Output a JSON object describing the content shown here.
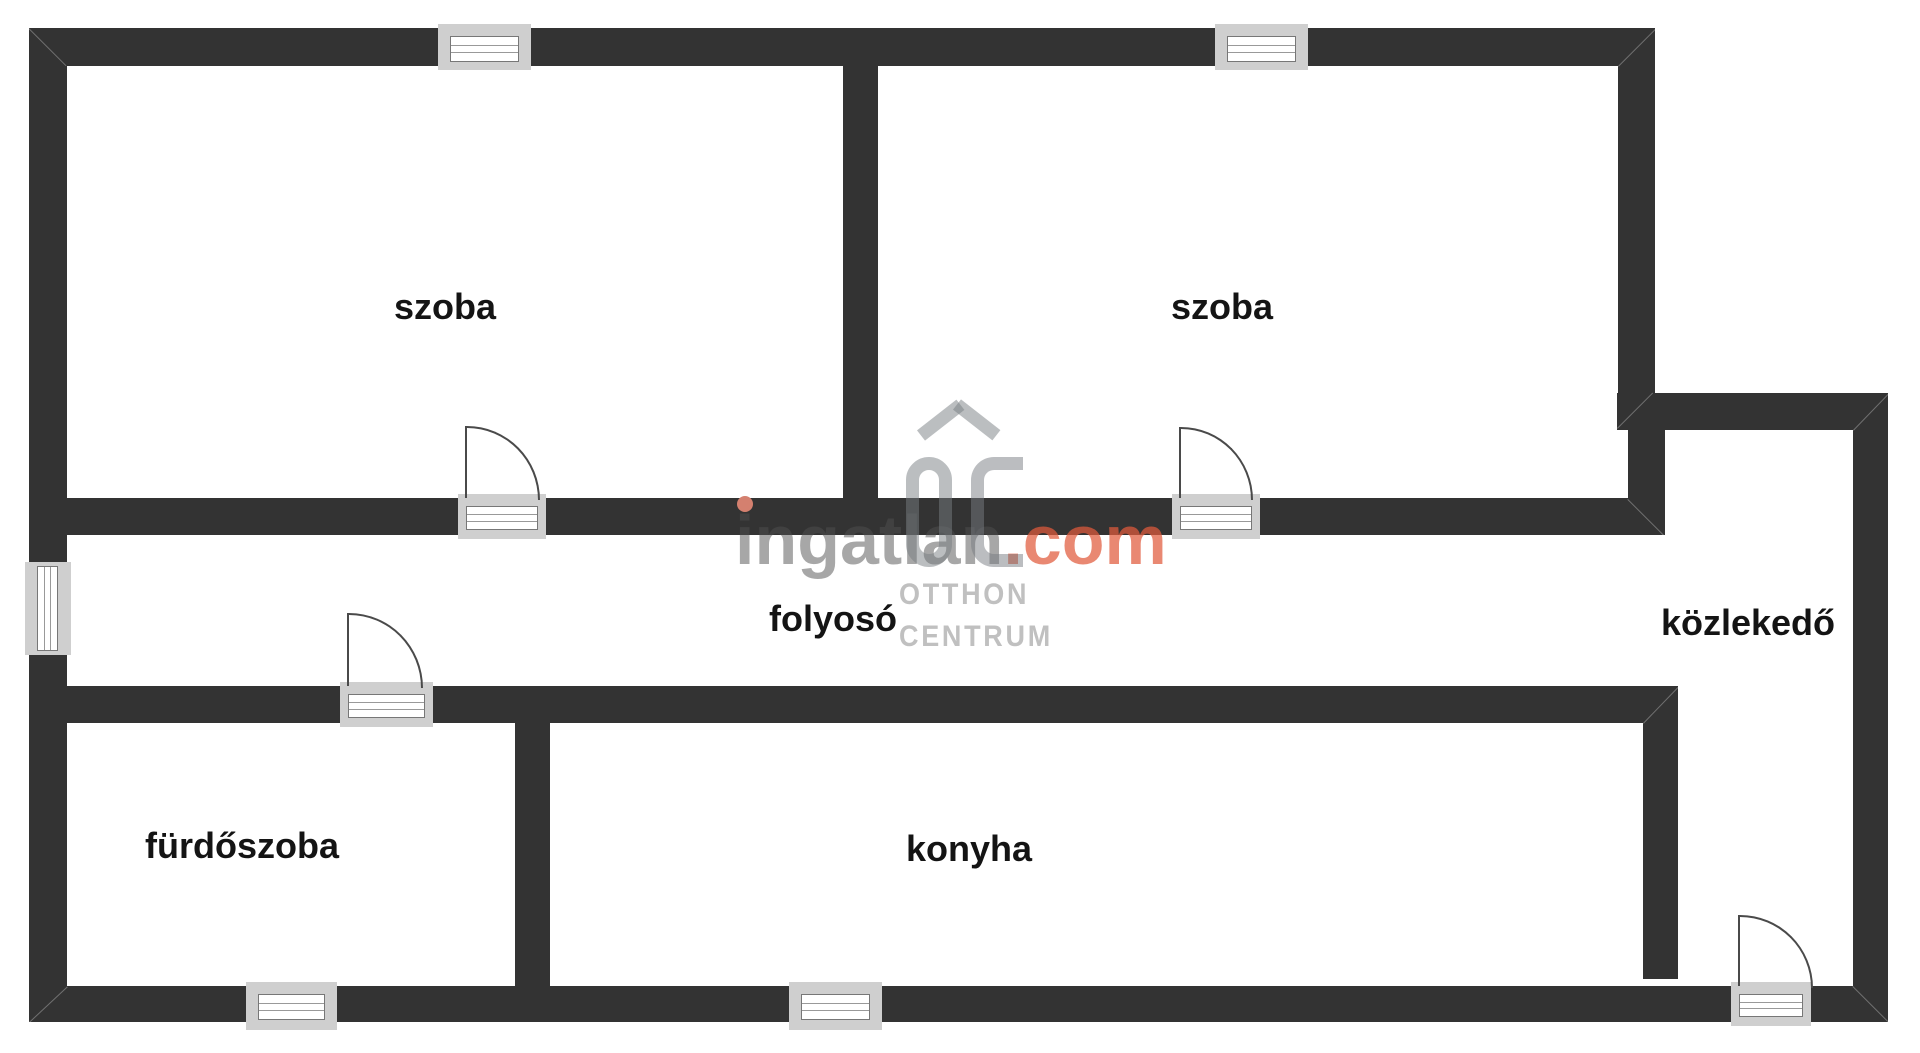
{
  "plan": {
    "type": "floor-plan",
    "rooms": [
      {
        "id": "szoba-1",
        "label": "szoba"
      },
      {
        "id": "szoba-2",
        "label": "szoba"
      },
      {
        "id": "folyoso",
        "label": "folyosó"
      },
      {
        "id": "kozlekedo",
        "label": "közlekedő"
      },
      {
        "id": "furdoszoba",
        "label": "fürdőszoba"
      },
      {
        "id": "konyha",
        "label": "konyha"
      }
    ],
    "counts": {
      "windows": 5,
      "doors": 4
    },
    "colors": {
      "wall": "#333333",
      "opening_sill": "#cfcfcf",
      "frame_line": "#777777",
      "label_text": "#141414",
      "background": "#ffffff"
    }
  },
  "watermark": {
    "brand": {
      "gray_part": "ingatlan",
      "accent_part": ".com"
    },
    "agency": {
      "monogram": "OC",
      "line1": "OTTHON",
      "line2": "CENTRUM"
    },
    "colors": {
      "brand_gray": "#a7a7a7",
      "brand_accent": "#e88872",
      "brand_i_dot": "#d4806f",
      "agency_gray": "#c0c0c0",
      "logo_gray": "#b1b4b8"
    }
  }
}
